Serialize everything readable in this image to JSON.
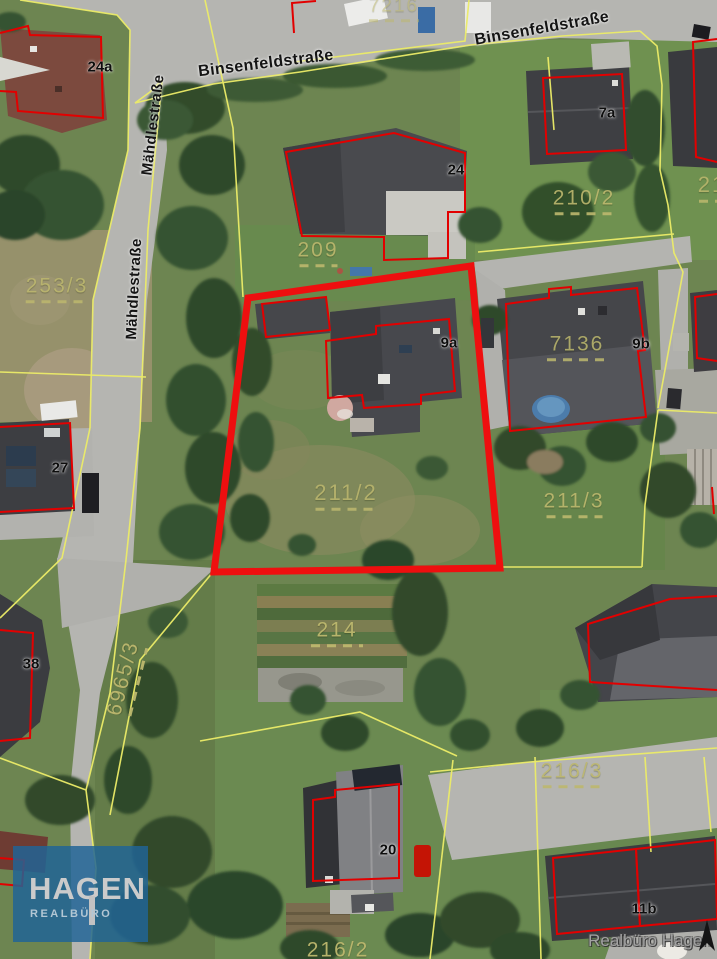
{
  "map": {
    "highlighted_parcel": "211/2",
    "street_labels": [
      {
        "text": "Binsenfeldstraße",
        "x": 266,
        "y": 64,
        "rot": -7
      },
      {
        "text": "Binsenfeldstraße",
        "x": 542,
        "y": 29,
        "rot": -10
      },
      {
        "text": "Mähdlestraße",
        "x": 153,
        "y": 125,
        "rot": -83
      },
      {
        "text": "Mähdlestraße",
        "x": 134,
        "y": 289,
        "rot": -87
      }
    ],
    "parcel_labels": [
      {
        "text": "7216",
        "x": 394,
        "y": 9,
        "rot": 0,
        "size": 19,
        "opacity": 0.55,
        "dash": 50
      },
      {
        "text": "209",
        "x": 318,
        "y": 253,
        "rot": 0,
        "size": 21,
        "opacity": 0.9,
        "dash": 38
      },
      {
        "text": "253/3",
        "x": 57,
        "y": 289,
        "rot": 0,
        "size": 21,
        "opacity": 0.85,
        "dash": 62
      },
      {
        "text": "210/2",
        "x": 584,
        "y": 201,
        "rot": 0,
        "size": 21,
        "opacity": 0.9,
        "dash": 58
      },
      {
        "text": "21",
        "x": 712,
        "y": 188,
        "rot": 0,
        "size": 22,
        "opacity": 0.85,
        "dash": 26
      },
      {
        "text": "7136",
        "x": 577,
        "y": 347,
        "rot": 0,
        "size": 21,
        "opacity": 0.85,
        "dash": 60
      },
      {
        "text": "211/2",
        "x": 346,
        "y": 496,
        "rot": 0,
        "size": 22,
        "opacity": 0.85,
        "dash": 62
      },
      {
        "text": "211/3",
        "x": 574,
        "y": 504,
        "rot": 0,
        "size": 21,
        "opacity": 0.9,
        "dash": 56
      },
      {
        "text": "214",
        "x": 337,
        "y": 633,
        "rot": 0,
        "size": 21,
        "opacity": 0.95,
        "dash": 52
      },
      {
        "text": "6965/3",
        "x": 126,
        "y": 679,
        "rot": -76,
        "size": 21,
        "opacity": 0.95,
        "dash": 70
      },
      {
        "text": "216/3",
        "x": 572,
        "y": 774,
        "rot": 0,
        "size": 21,
        "opacity": 0.9,
        "dash": 58
      },
      {
        "text": "216/2",
        "x": 338,
        "y": 950,
        "rot": 0,
        "size": 21,
        "opacity": 0.95,
        "dash": 0
      }
    ],
    "house_numbers": [
      {
        "text": "24a",
        "x": 100,
        "y": 67
      },
      {
        "text": "24",
        "x": 456,
        "y": 170
      },
      {
        "text": "7a",
        "x": 607,
        "y": 113
      },
      {
        "text": "9a",
        "x": 449,
        "y": 343
      },
      {
        "text": "9b",
        "x": 641,
        "y": 344
      },
      {
        "text": "27",
        "x": 60,
        "y": 468
      },
      {
        "text": "38",
        "x": 31,
        "y": 664
      },
      {
        "text": "20",
        "x": 388,
        "y": 850
      },
      {
        "text": "11b",
        "x": 644,
        "y": 909
      }
    ]
  },
  "branding": {
    "logo_title": "HAGEN",
    "logo_subtitle": "REALBÜRO",
    "watermark": "Realbüro Hagen"
  },
  "colors": {
    "highlight_red": "#ee0f0f",
    "building_outline_red": "#e20000",
    "parcel_line_yellow": "#ecec68",
    "parcel_label_olive": "#bdb86e",
    "logo_blue": "#20648f"
  }
}
